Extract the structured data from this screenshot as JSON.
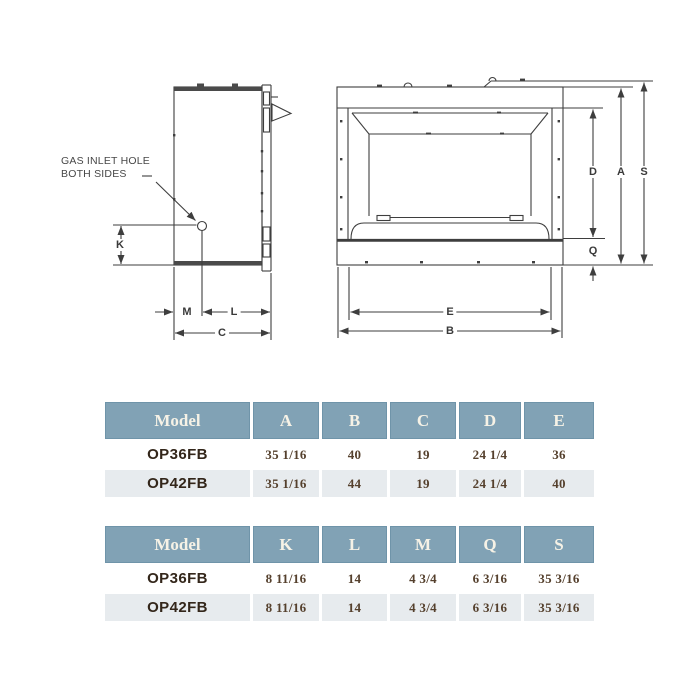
{
  "colors": {
    "header-bg": "#81a2b5",
    "header-border": "#6f94a9",
    "header-text": "#f6f2e6",
    "row-alt-bg": "#e7ebee",
    "model-text": "#33261a",
    "value-text": "#55402d",
    "line-color": "#3e3e3e"
  },
  "diagram": {
    "gas_note": {
      "line1": "GAS INLET HOLE",
      "line2": "BOTH SIDES"
    },
    "dim_labels": {
      "K": "K",
      "M": "M",
      "L": "L",
      "C": "C",
      "D": "D",
      "A": "A",
      "S": "S",
      "Q": "Q",
      "E": "E",
      "B": "B"
    }
  },
  "tables": [
    {
      "headers": [
        "Model",
        "A",
        "B",
        "C",
        "D",
        "E"
      ],
      "rows": [
        {
          "model": "OP36FB",
          "values": [
            "35 1/16",
            "40",
            "19",
            "24 1/4",
            "36"
          ]
        },
        {
          "model": "OP42FB",
          "values": [
            "35 1/16",
            "44",
            "19",
            "24 1/4",
            "40"
          ]
        }
      ]
    },
    {
      "headers": [
        "Model",
        "K",
        "L",
        "M",
        "Q",
        "S"
      ],
      "rows": [
        {
          "model": "OP36FB",
          "values": [
            "8 11/16",
            "14",
            "4 3/4",
            "6 3/16",
            "35 3/16"
          ]
        },
        {
          "model": "OP42FB",
          "values": [
            "8 11/16",
            "14",
            "4 3/4",
            "6 3/16",
            "35 3/16"
          ]
        }
      ]
    }
  ]
}
